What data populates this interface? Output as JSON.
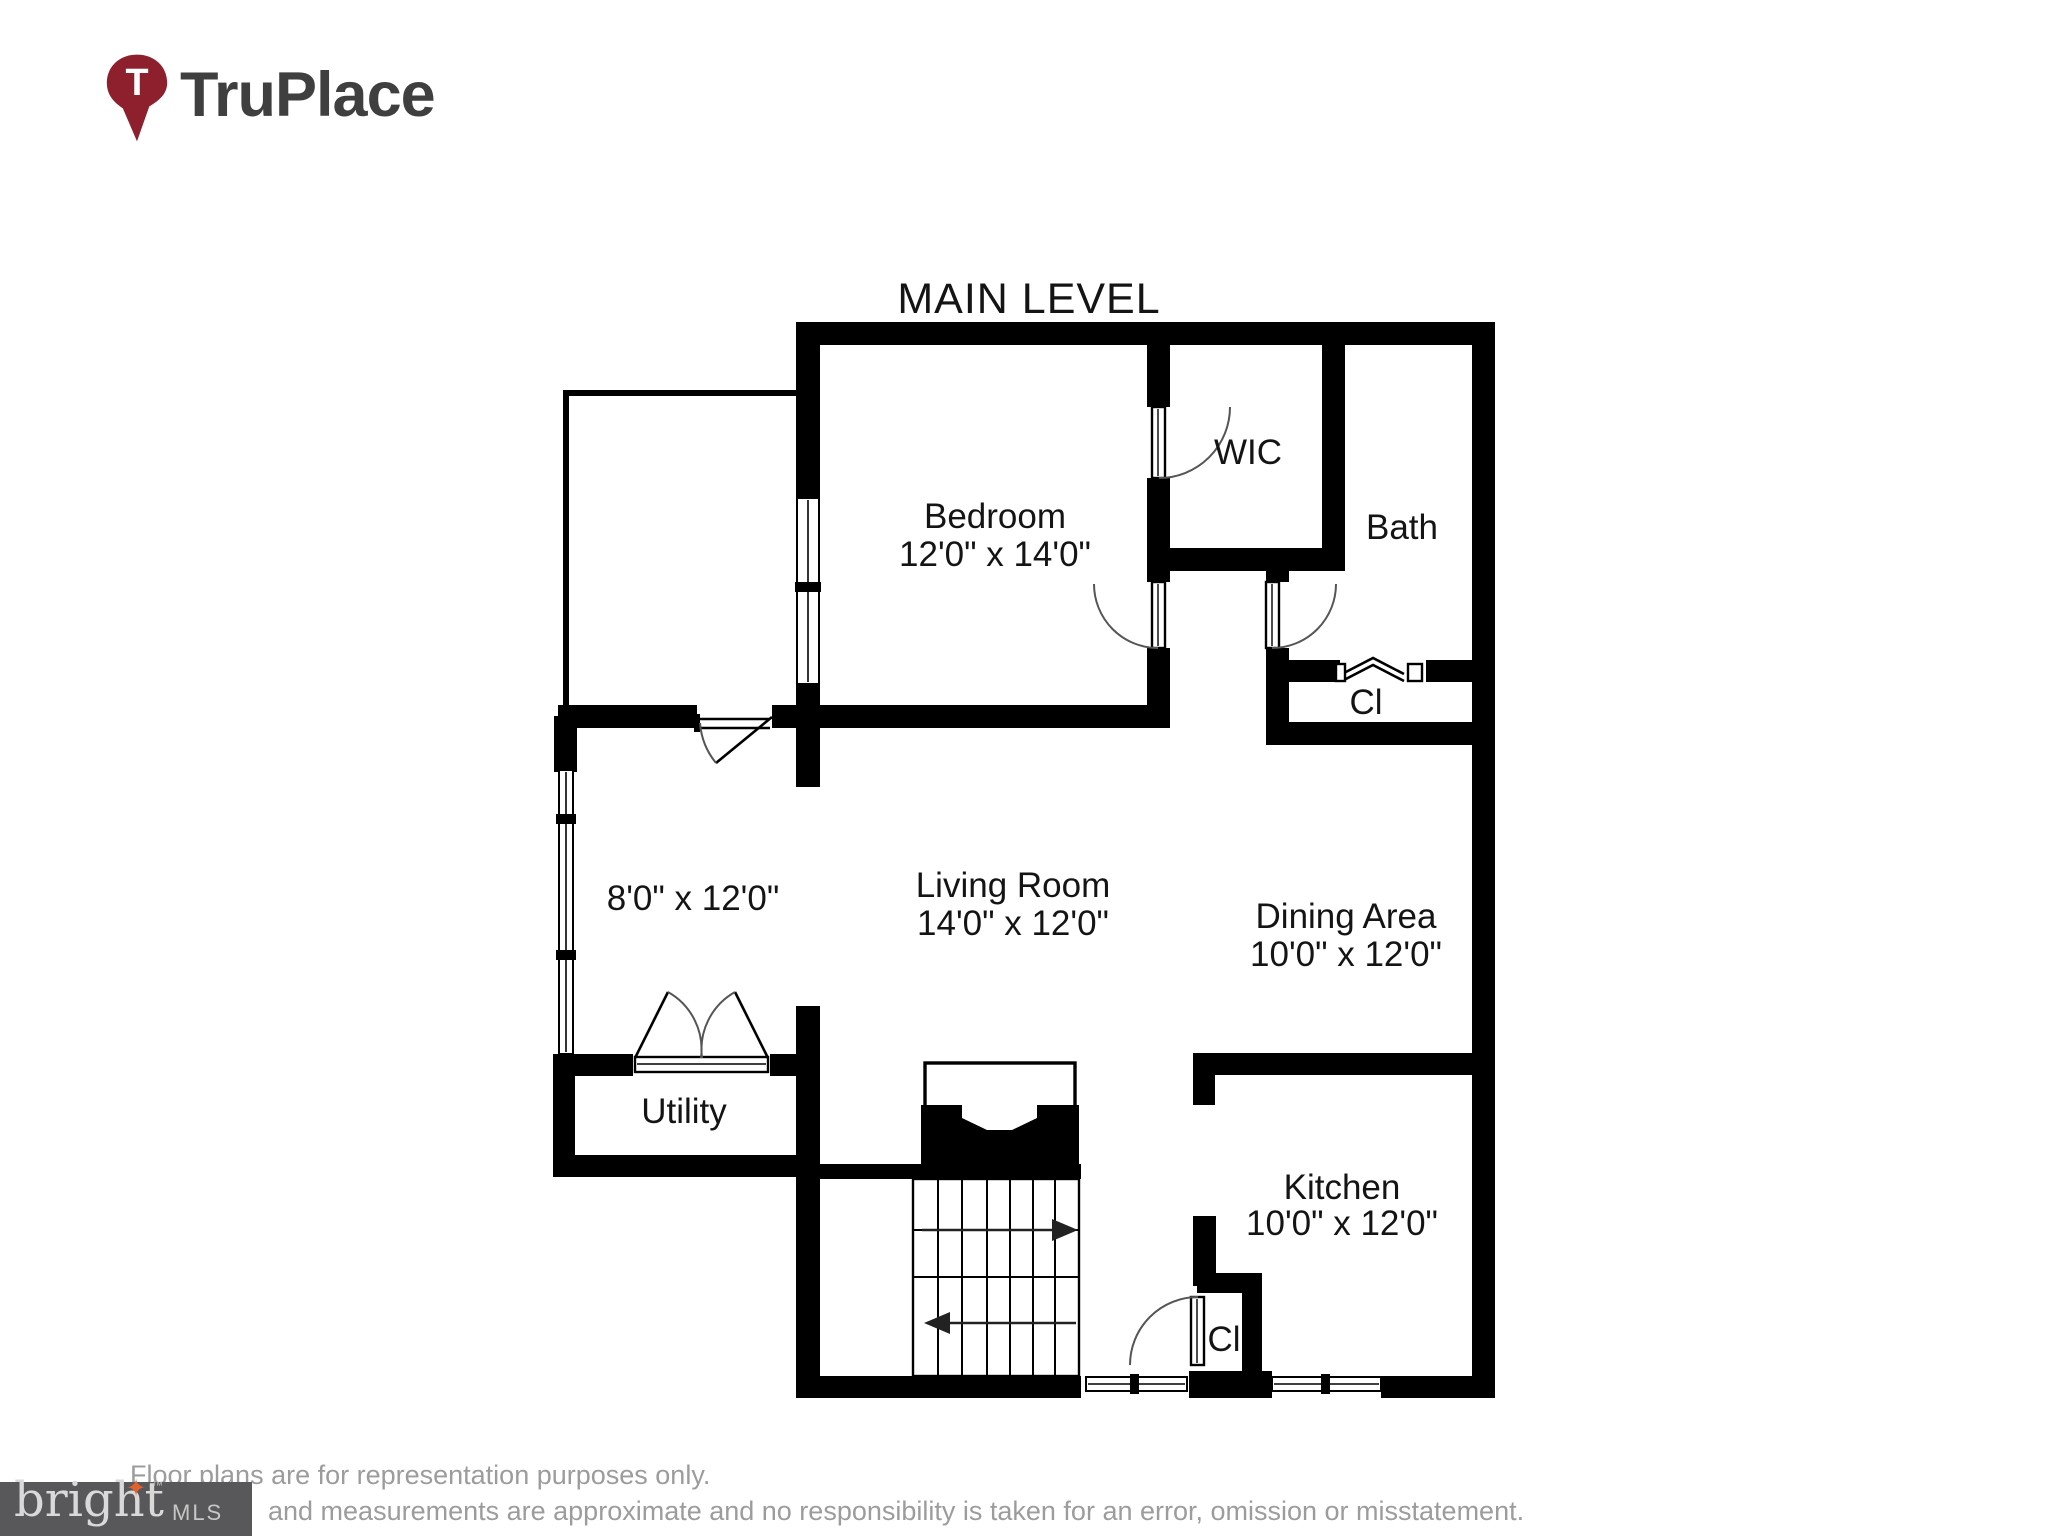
{
  "brand": {
    "name": "TruPlace",
    "pin_letter": "T",
    "pin_color": "#8e202e",
    "text_color": "#3f3f3f"
  },
  "plan": {
    "title": "MAIN LEVEL",
    "rooms": {
      "bedroom": {
        "name": "Bedroom",
        "dims": "12'0\" x 14'0\""
      },
      "wic": {
        "name": "WIC"
      },
      "bath": {
        "name": "Bath"
      },
      "hall_closet": {
        "name": "Cl"
      },
      "sunroom": {
        "dims": "8'0\" x 12'0\""
      },
      "living_room": {
        "name": "Living Room",
        "dims": "14'0\" x 12'0\""
      },
      "dining_area": {
        "name": "Dining Area",
        "dims": "10'0\" x 12'0\""
      },
      "utility": {
        "name": "Utility"
      },
      "kitchen": {
        "name": "Kitchen",
        "dims": "10'0\" x 12'0\""
      },
      "kitchen_closet": {
        "name": "Cl"
      }
    }
  },
  "footer": {
    "disclaimer_line1": "Floor plans are for representation purposes only.",
    "disclaimer_line2": "and measurements are approximate and no responsibility is taken for an error, omission or misstatement.",
    "mls_logo": {
      "brand": "bright",
      "tm": "™",
      "suffix": "MLS",
      "star": "✦",
      "bg_color": "#58585a",
      "star_color": "#e2622e"
    }
  }
}
